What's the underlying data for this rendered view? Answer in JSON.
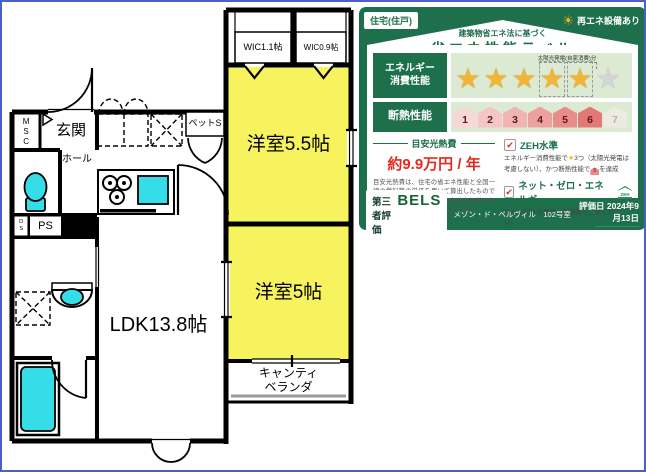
{
  "colors": {
    "room_yellow": "#f7f35f",
    "fixture_cyan": "#35dde8",
    "wall_black": "#000000",
    "frame_blue": "#4b5fc8",
    "label_green": "#1e6f4c",
    "cost_red": "#e02b20",
    "star_gold": "#f2b637"
  },
  "floor_plan": {
    "rooms": {
      "wic1": "WIC1.1帖",
      "wic2": "WIC0.9帖",
      "bedroom1": "洋室5.5帖",
      "bedroom2": "洋室5帖",
      "ldk": "LDK13.8帖",
      "entrance": "玄関",
      "hall": "ホール",
      "msc": "MSC",
      "ds": "DS",
      "ps": "PS",
      "pet": "ペットS",
      "veranda_l1": "キャンティ",
      "veranda_l2": "ベランダ"
    }
  },
  "energy_label": {
    "header": {
      "housing_type": "住宅(住戸)",
      "renewable": "再エネ設備あり",
      "law_note": "建築物省エネ法に基づく",
      "title": "省エネ性能ラベル"
    },
    "energy_row": {
      "label_line1": "エネルギー",
      "label_line2": "消費性能",
      "solar_note": "太陽光発電(自家消費)分",
      "star_glyph": "★",
      "stars_solid": 3,
      "stars_solar": 2,
      "stars_total": 6
    },
    "insulation_row": {
      "label": "断熱性能",
      "levels": [
        "1",
        "2",
        "3",
        "4",
        "5",
        "6",
        "7"
      ],
      "achieved": 6,
      "level_colors": [
        "#f6d8d6",
        "#f3c7c5",
        "#f0b5b3",
        "#eda19f",
        "#e98d8b",
        "#e47876",
        "#ecebe3"
      ]
    },
    "cost": {
      "heading": "目安光熱費",
      "amount": "約9.9万円 / 年",
      "note": "目安光熱費は、住宅の省エネ性能と全国一律の燃料等の単価を用いて算出したものです。実際の光熱費は、使用条件や設備、契約会社・方法などにより異なります。"
    },
    "zeh": {
      "check_glyph": "✔",
      "check1_label": "ZEH水準",
      "note1_pre": "エネルギー消費性能で",
      "note1_star_count": "3つ（太陽光発電",
      "note1_mid": "は考慮しない）、かつ断熱性能で",
      "note1_house_level": "5",
      "note1_post": "を達成",
      "check2_label": "ネット・ゼロ・エネルギー",
      "zeh_badge": "ZEH",
      "note2": "NearlyZEH の要件は評価書をご覧ください。"
    },
    "footer": {
      "third_party": "第三者評価",
      "brand": "BELS",
      "building": "メゾン・ド・ベルヴィル　102号室",
      "eval_date": "評価日 2024年9月13日",
      "code": "―――――――――――"
    }
  }
}
